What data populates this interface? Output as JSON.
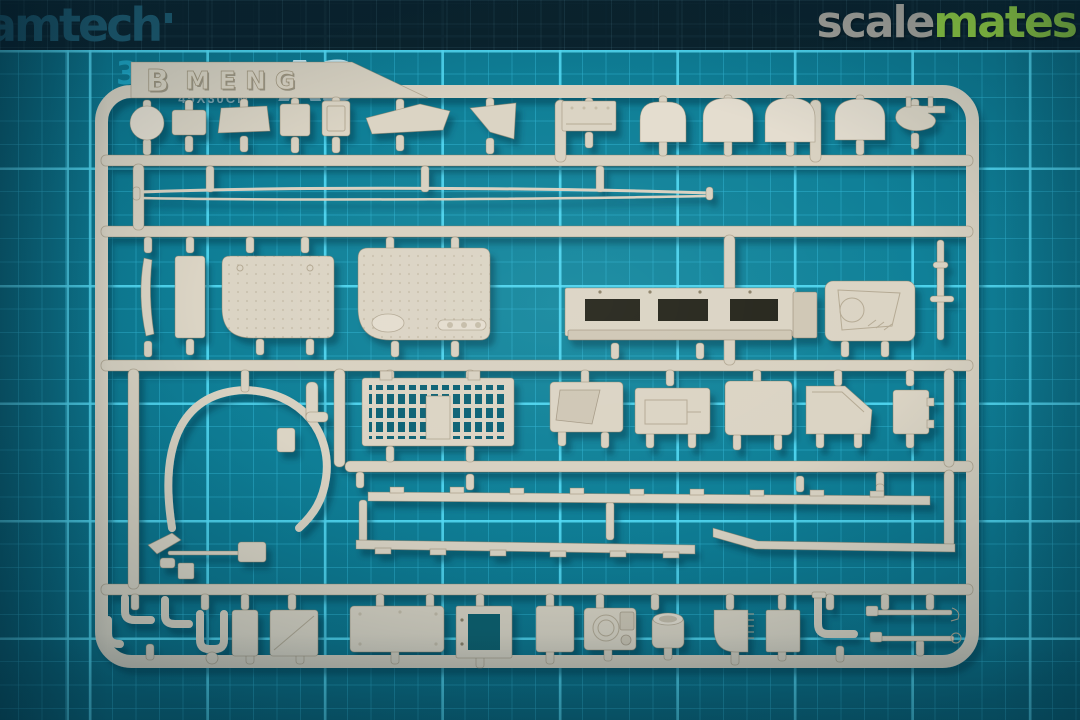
{
  "mat": {
    "brand": "amtech",
    "size_code": "A3",
    "label_lines": [
      "CUTTING",
      "MAT",
      "45X30CM"
    ],
    "grid_digit": "3",
    "base_color": "#0e7d95",
    "grid_line_color": "#2fb2d0",
    "grid_major_color": "#56def8",
    "header_band_color": "#0b1b25"
  },
  "watermark": {
    "part1": "scale",
    "part2": "mates",
    "part1_color": "#a5a29a",
    "part2_color": "#8dc63f"
  },
  "sprue": {
    "runner_letter": "B",
    "brand_embossed": "MENG",
    "plastic_color": "#dbd4c4"
  }
}
